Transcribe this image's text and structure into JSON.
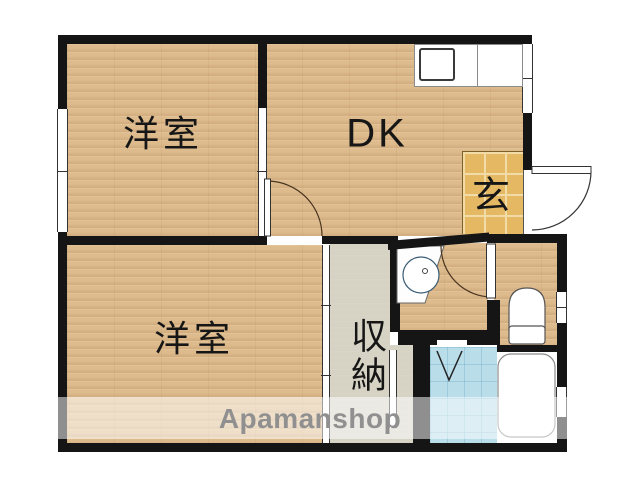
{
  "floorplan": {
    "rooms": {
      "western_room_top": {
        "label": "洋室"
      },
      "dining_kitchen": {
        "label": "DK"
      },
      "entrance": {
        "label": "玄"
      },
      "western_room_bottom": {
        "label": "洋室"
      },
      "storage": {
        "label": "収納"
      }
    },
    "watermark": {
      "text": "Apamanshop"
    },
    "colors": {
      "wall": "#151515",
      "wood_floor": "#debb8d",
      "entrance_tile": "#e5b863",
      "storage_floor": "#d6d2c4",
      "bathroom_tile": "#b9dde9",
      "fixture_outline": "#555555",
      "watermark_text": "#909090"
    }
  }
}
